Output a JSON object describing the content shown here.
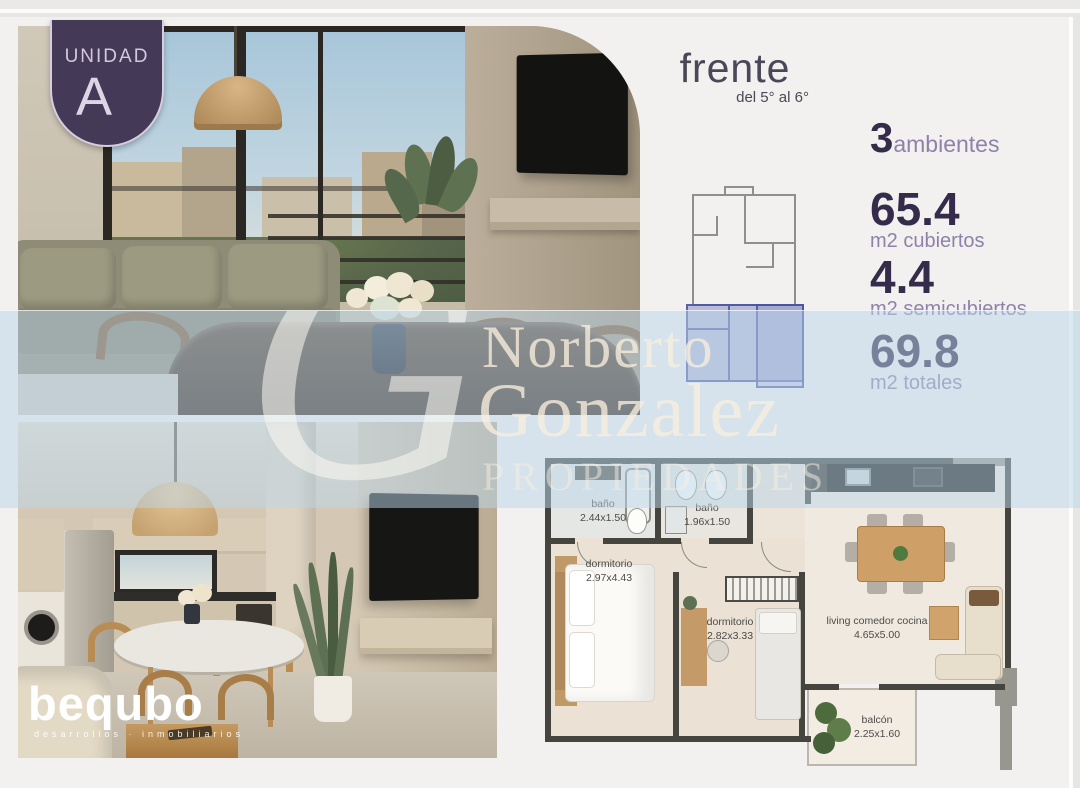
{
  "badge": {
    "label": "UNIDAD",
    "letter": "A"
  },
  "orientation": {
    "title": "frente",
    "subtitle": "del 5° al 6°"
  },
  "stats": {
    "ambientes": {
      "value": "3",
      "label": "ambientes"
    },
    "cubiertos": {
      "value": "65.4",
      "label": "m2 cubiertos"
    },
    "semicubiertos": {
      "value": "4.4",
      "label": "m2 semicubiertos"
    },
    "totales": {
      "value": "69.8",
      "label": "m2 totales"
    }
  },
  "watermark": {
    "monogram": "G",
    "line1": "Norberto",
    "line2": "Gonzalez",
    "line3": "PROPIEDADES"
  },
  "brand": {
    "name": "bequbo",
    "tagline": "desarrollos · inmobiliarios"
  },
  "floorplan": {
    "rooms": {
      "bath1": {
        "name": "baño",
        "dims": "2.44x1.50"
      },
      "bath2": {
        "name": "baño",
        "dims": "1.96x1.50"
      },
      "bedroom1": {
        "name": "dormitorio",
        "dims": "2.97x4.43"
      },
      "bedroom2": {
        "name": "dormitorio",
        "dims": "2.82x3.33"
      },
      "living": {
        "name": "living comedor cocina",
        "dims": "4.65x5.00"
      },
      "balcony": {
        "name": "balcón",
        "dims": "2.25x1.60"
      }
    }
  },
  "colors": {
    "accent_purple": "#443a57",
    "stat_number": "#342c4a",
    "stat_label": "#8f81a9",
    "watermark_band": "#bad6ea"
  }
}
